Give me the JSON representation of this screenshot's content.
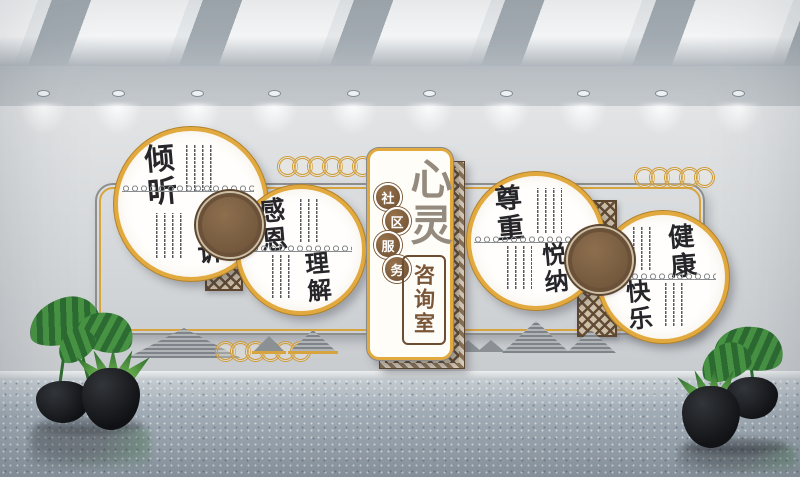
{
  "meta": {
    "description": "3D render of a community counseling room culture wall",
    "style": "chinese-classical"
  },
  "palette": {
    "gold": "#d8a43e",
    "brown": "#7d5b3a",
    "dark_brown": "#5e4730",
    "lattice_tan": "#cdbfa7",
    "ink": "#26262a",
    "title_gray": "#948a7d",
    "wall_gray": "#d6d9db",
    "floor_gray": "#a2adb7",
    "plant_green": "#479343",
    "pot_black": "#101114"
  },
  "banner": {
    "service_badges": [
      "社",
      "区",
      "服",
      "务"
    ],
    "title_chars": "心灵",
    "subtitle_chars": "咨询室"
  },
  "circles": [
    {
      "primary": "倾听",
      "secondary": "倾诉"
    },
    {
      "primary": "感恩",
      "secondary": "理解"
    },
    {
      "primary": "尊重",
      "secondary": "悦纳"
    },
    {
      "primary": "健康",
      "secondary": "快乐"
    }
  ],
  "room": {
    "spotlight_count": 10,
    "skylight_panel_count": 7,
    "plant_pot_count": 4
  }
}
